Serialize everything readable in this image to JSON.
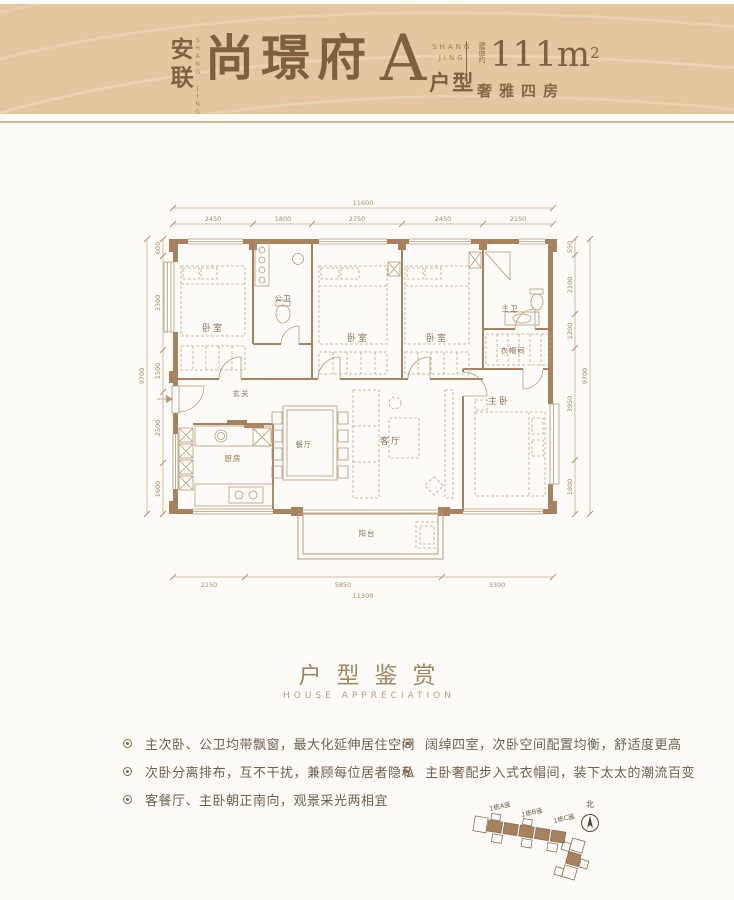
{
  "colors": {
    "band": "#e4c6a0",
    "accent_brown": "#8a6845",
    "wall_brown": "#a6825f",
    "rule": "#d9b88e"
  },
  "header": {
    "brand_cn": "安联",
    "brand_en": "SHANG JING",
    "project_name": "尚璟府",
    "unit_letter": "A",
    "unit_suffix": "户型",
    "unit_en_line1": "SHANG",
    "unit_en_line2": "JING",
    "area_prefix": "建面约",
    "area_value": "111m",
    "area_sup": "2",
    "tagline": "奢雅四房"
  },
  "floorplan": {
    "rooms": {
      "bedroom_a": "卧室",
      "guest_bath": "公卫",
      "bedroom_b": "卧室",
      "bedroom_c": "卧室",
      "master_bath": "主卫",
      "cloakroom": "衣帽间",
      "master_bedroom": "主卧",
      "foyer": "玄关",
      "kitchen": "厨房",
      "dining": "餐厅",
      "living": "客厅",
      "balcony": "阳台"
    },
    "dims": {
      "top_overall": "11600",
      "top": [
        "2450",
        "1800",
        "2750",
        "2450",
        "2150"
      ],
      "left_overall": "9700",
      "left": [
        "600",
        "3300",
        "1500",
        "2500",
        "1600"
      ],
      "right_overall": "9700",
      "right": [
        "550",
        "2100",
        "1200",
        "3950",
        "1800"
      ],
      "bottom_overall": "11300",
      "bottom": [
        "2150",
        "5850",
        "3300"
      ]
    }
  },
  "section": {
    "title": "户型鉴赏",
    "subtitle": "HOUSE APPRECIATION",
    "bullets_left": [
      "主次卧、公卫均带飘窗，最大化延伸居住空间",
      "次卧分离排布，互不干扰，兼顾每位居者隐私",
      "客餐厅、主卧朝正南向，观景采光两相宜"
    ],
    "bullets_right": [
      "阔绰四室，次卧空间配置均衡，舒适度更高",
      "主卧奢配步入式衣帽间，装下太太的潮流百变"
    ]
  },
  "siteplan": {
    "buildings": [
      "1栋A座",
      "1栋B座",
      "1栋C座"
    ],
    "north": "北"
  }
}
